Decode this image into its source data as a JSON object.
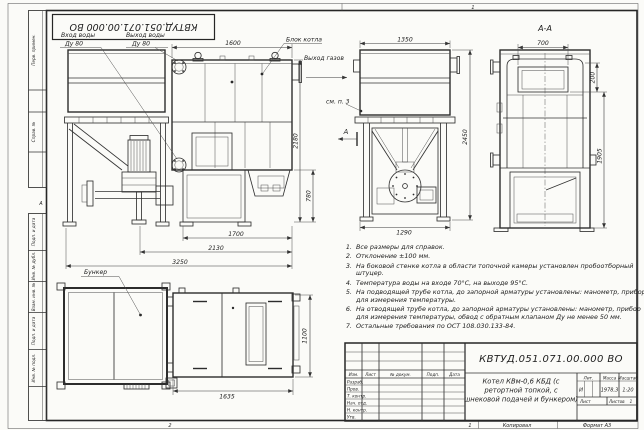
{
  "frame": {
    "stamp_number": "КВТУД.051.071.00.000 ВО",
    "margin": {
      "perv": "Перв. примен.",
      "sprav": "Справ. №",
      "podp1": "Подп. и дата",
      "inv_dubl": "Инв. № дубл.",
      "vzam": "Взам. инв. №",
      "podp2": "Подп. и дата",
      "inv_podl": "Инв. № подл.",
      "marker_a": "А"
    },
    "zone_top": "1",
    "zone_bottom_left": "2",
    "sheet_no": "1",
    "copied": "Копировал",
    "format": "Формат А3"
  },
  "labels": {
    "vhod_vody": "Вход воды",
    "vhod_du": "Ду 80",
    "vyhod_vody": "Выход воды",
    "vyhod_du": "Ду 80",
    "blok_kotla": "Блок котла",
    "vyhod_gazov": "Выход газов",
    "sm_p3": "см. п. 3",
    "bunker": "Бункер",
    "section_title": "А-А",
    "section_arrow": "А"
  },
  "dims": {
    "side_top": "1600",
    "side_height": "2180",
    "side_lower": "780",
    "side_b1": "1700",
    "side_b2": "2130",
    "side_b3": "3250",
    "front_top": "1350",
    "front_height": "2450",
    "front_bottom": "1290",
    "sec_top": "700",
    "sec_upper": "200",
    "sec_right": "1905",
    "plan_bottom": "1635",
    "plan_right": "1100"
  },
  "notes": [
    "Все размеры для справок.",
    "Отклонение ±100 мм.",
    "На боковой стенке котла в области топочной камеры установлен пробоотборный штуцер.",
    "Температура воды на входе 70°С, на выходе 95°С.",
    "На подводящей трубе котла, до запорной арматуры установлены: манометр, прибор для измерения температуры.",
    "На отводящей трубе котла, до запорной арматуры установлены: манометр, прибор для измерения температуры, обвод с обратным клапаном Ду не менее 50 мм.",
    "Остальные требования по ОСТ 108.030.133-84."
  ],
  "title_block": {
    "doc_number": "КВТУД.051.071.00.000 ВО",
    "name_line1": "Котел КВм-0,6 КБД (с",
    "name_line2": "ретортной топкой, с",
    "name_line3": "шнековой подачей и бункером)",
    "col_izm": "Изм.",
    "col_list": "Лист",
    "col_dokum": "№ докум.",
    "col_podp": "Подп.",
    "col_data": "Дата",
    "row_razrab": "Разраб.",
    "row_prov": "Пров.",
    "row_tkontr": "Т. контр.",
    "row_nach": "Нач. отд.",
    "row_nkontr": "Н. контр.",
    "row_utv": "Утв.",
    "lit_label": "Лит.",
    "lit_value": "И",
    "massa_label": "Масса",
    "massa_value": "1978,3",
    "scale_label": "Масштаб",
    "scale_value": "1:20",
    "list_label": "Лист",
    "listov_label": "Листов",
    "listov_value": "1"
  }
}
